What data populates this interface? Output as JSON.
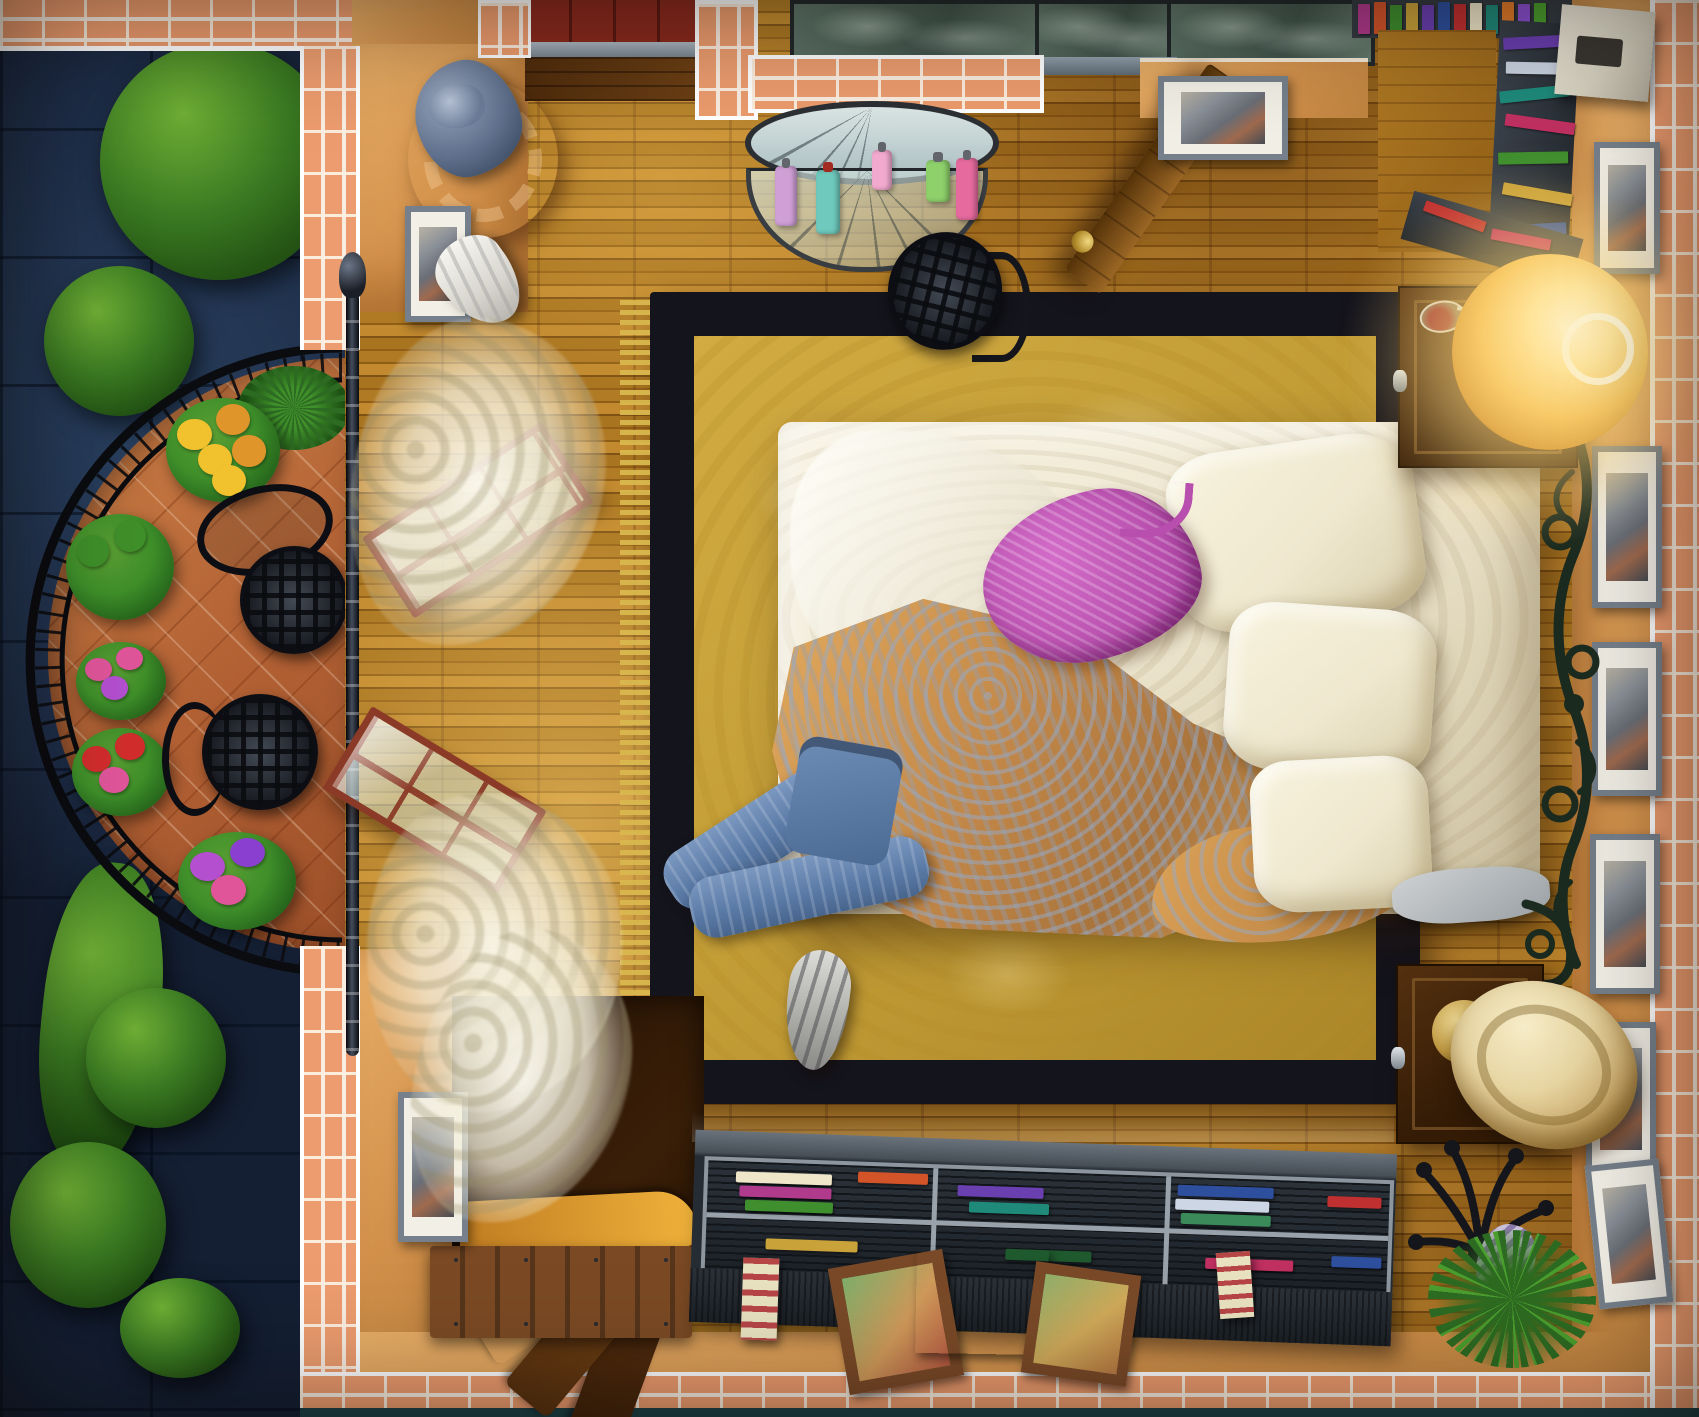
{
  "scene": {
    "title": "Top-down bedroom with balcony",
    "style": "hidden-object game scene, bird's-eye view",
    "lighting": "night outside, one bedside lamp lit"
  },
  "palette": {
    "floor_parquet": "#a9741f",
    "wall_tan": "#dfa35c",
    "brick": "#ec9c6e",
    "mortar_white": "#f9ece0",
    "outdoor_stone": "#1d2c46",
    "tree_green": "#3b7a22",
    "balcony_terracotta": "#b26134",
    "iron_black": "#0c0e14",
    "rug_gold": "#c9a43e",
    "rug_border": "#14141c",
    "sheet_cream": "#efe8d4",
    "blanket_orange": "#d59a50",
    "nightgown_magenta": "#bf55b4",
    "jeans_blue": "#6d8db6",
    "lamp_glow": "#ffd97e",
    "lamp_shade": "#e9d9a6",
    "shelf_charcoal": "#343b42",
    "marble_green": "#5f7569",
    "red_tile": "#8a2a1e",
    "teal_baseboard": "#1d4046"
  },
  "objects": {
    "bed": "unmade double bed",
    "pillows": "satin pillows",
    "gray_pillow": "small gray pillow",
    "nightgown": "magenta nightgown on bed",
    "blanket": "orange damask duvet",
    "rug": "golden rug with black border",
    "jeans": "blue jeans dropped on rug",
    "sneaker_gray": "gray sneaker",
    "sneaker_white": "white sneaker",
    "lamp_lit": "lit bedside lamp",
    "lamp_off": "bedside lamp with cream shade",
    "nightstand": "dark wood nightstand",
    "wine_glass": "toppled wine glass",
    "statue": "blue-gray figurine",
    "pedestal": "carved wooden stool",
    "mirror": "iron-framed half mirror",
    "console": "glass console with perfume bottles",
    "iron_chair": "wrought-iron chair",
    "door": "wooden door standing open",
    "frame": "framed picture",
    "balcony": "semicircular balcony terrace",
    "railing": "wrought-iron railing",
    "flowers": "potted balcony flowers",
    "palm_plant": "potted palm",
    "stairs": "spiral stair descending",
    "hatch": "wooden plank hatch",
    "shelf": "low open bookshelf",
    "books": "stacked books",
    "keepsakes": "keepsake boxes and photo frames",
    "niche": "book niche in corner",
    "white_box": "cream storage box",
    "coat_rack": "toppled coat rack",
    "curtain": "sheer curtain blowing",
    "window": "balcony window leaf",
    "rod": "black curtain rod",
    "tree": "tree canopy outside",
    "marble": "marble hall beyond wall",
    "brick_wall": "brick outer wall"
  },
  "bottles": {
    "colors": [
      "#cf9fd6",
      "#6fc9bd",
      "#8ed06a",
      "#f2a9ce",
      "#e66a9e"
    ]
  },
  "books_top": {
    "colors": [
      "#b03a8c",
      "#d4542a",
      "#3f8f2e",
      "#caa23a",
      "#6a3fb0",
      "#2e4f9e",
      "#c03030",
      "#efe5c8",
      "#1f8a7a",
      "#e07a2a",
      "#8a4fd0",
      "#4a9e2e"
    ]
  },
  "books_stack": {
    "colors": [
      "#6a3fb0",
      "#c9d2e0",
      "#1f8a7a",
      "#c03060",
      "#3f8f2e",
      "#caa23a",
      "#2e4f9e",
      "#c03030"
    ]
  },
  "books_bottom": {
    "colors": [
      "#efe5c8",
      "#b03a8c",
      "#3f8f2e",
      "#c78f3a",
      "#d4542a",
      "#1f8a7a",
      "#6a3fb0",
      "#2e4f9e",
      "#cdd6e4",
      "#3a8a5a",
      "#caa23a",
      "#1f5a2e",
      "#c03060",
      "#5a9e2e",
      "#c03030",
      "#2e4f9e"
    ]
  },
  "flowers": {
    "yellow": "#f2c22e",
    "gold": "#e0952a",
    "pink": "#e0559a",
    "red": "#d22d2d",
    "magenta": "#b44fd0",
    "purple": "#8a3fd0",
    "leaf": "#3f8f2a"
  }
}
